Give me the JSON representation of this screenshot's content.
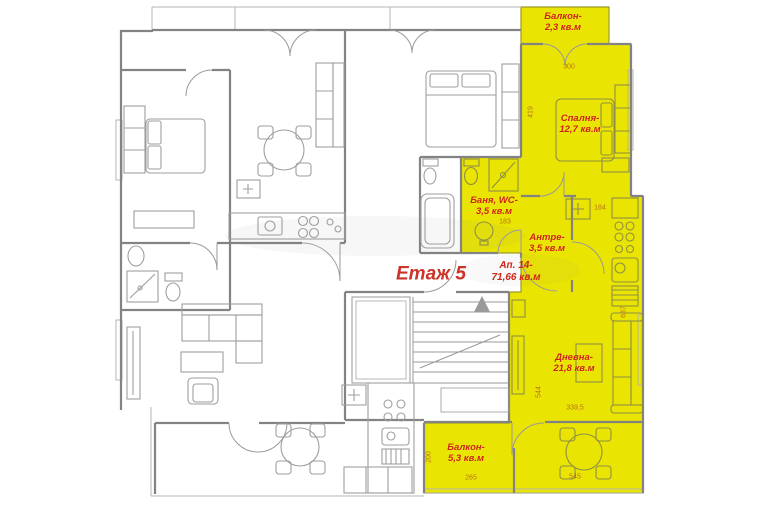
{
  "plan": {
    "floor_label": "Етаж 5",
    "apartment_label": {
      "line1": "Ап. 14-",
      "line2": "71,66 кв.м"
    },
    "rooms": {
      "balcony_top": {
        "line1": "Балкон-",
        "line2": "2,3 кв.м"
      },
      "bedroom": {
        "line1": "Спалня-",
        "line2": "12,7 кв.м"
      },
      "bath": {
        "line1": "Баня, WC-",
        "line2": "3,5 кв.м"
      },
      "antre": {
        "line1": "Антре-",
        "line2": "3,5 кв.м"
      },
      "living": {
        "line1": "Дневна-",
        "line2": "21,8 кв.м"
      },
      "balcony_bottom": {
        "line1": "Балкон-",
        "line2": "5,3 кв.м"
      }
    },
    "dims": {
      "d300": "300",
      "d419": "419",
      "d184": "184",
      "d183": "183",
      "d637": "637",
      "d544": "544",
      "d339": "339,5",
      "d200": "200",
      "d265": "265",
      "d545": "545"
    },
    "colors": {
      "highlight": "#e9e402",
      "room_label": "#ce2317",
      "dim_label": "#b5731c",
      "wall": "#838383",
      "floor_label": "#cc342a"
    }
  }
}
